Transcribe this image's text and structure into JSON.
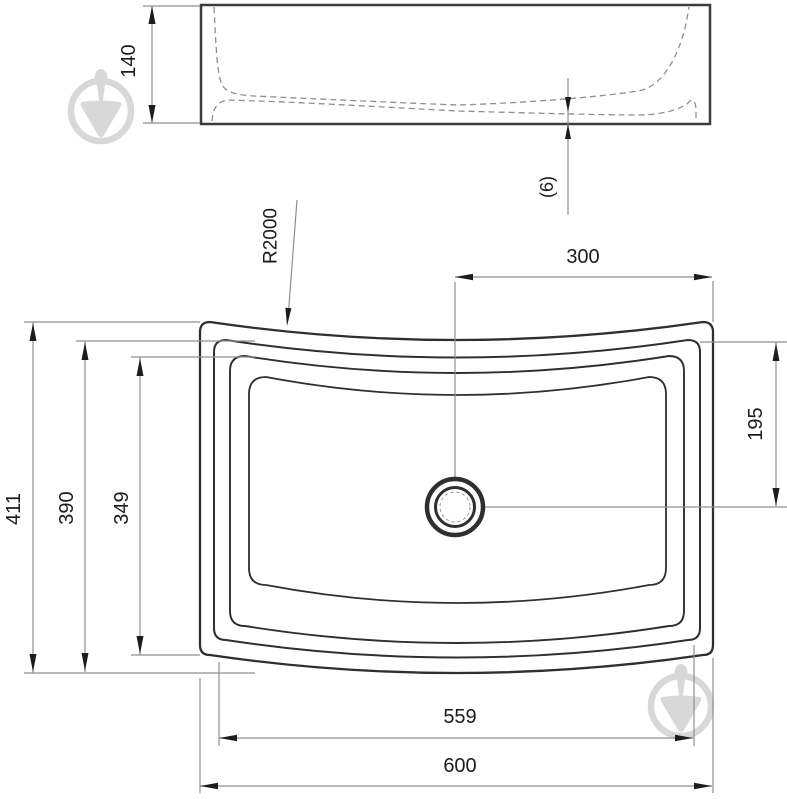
{
  "diagram": {
    "title": "Washbasin technical drawing (two orthographic views)",
    "views": {
      "side_view": "front elevation of basin with hidden interior profile (dashed)",
      "plan_view": "top view of basin with curved front/back edges and central drain"
    },
    "colors": {
      "background": "#ffffff",
      "contour": "#2f2f2f",
      "dimension_line": "#8f8f8f",
      "arrow_and_text": "#1c1c1c",
      "watermark": "#d8d8d8"
    },
    "watermark": {
      "name": "trowel-in-circle-logo",
      "positions": [
        "top-left",
        "bottom-right"
      ]
    }
  },
  "labels": {
    "side_height": "140",
    "bottom_thickness": "(6)",
    "edge_radius": "R2000",
    "drain_offset_x": "300",
    "drain_offset_y": "195",
    "overall_depth": "411",
    "basin_depth": "390",
    "inner_depth": "349",
    "inner_width": "559",
    "overall_width": "600"
  },
  "dimensions_mm": [
    {
      "value": "140",
      "meaning": "basin height, side view",
      "orientation": "vertical"
    },
    {
      "value": "(6)",
      "meaning": "bottom wall thickness reference",
      "orientation": "vertical"
    },
    {
      "value": "R2000",
      "meaning": "radius of curved front/back edge",
      "orientation": "leader"
    },
    {
      "value": "300",
      "meaning": "drain centre to right edge",
      "orientation": "horizontal"
    },
    {
      "value": "195",
      "meaning": "back edge to drain centre",
      "orientation": "vertical"
    },
    {
      "value": "411",
      "meaning": "overall depth",
      "orientation": "vertical"
    },
    {
      "value": "390",
      "meaning": "depth at centre line",
      "orientation": "vertical"
    },
    {
      "value": "349",
      "meaning": "inner bowl depth",
      "orientation": "vertical"
    },
    {
      "value": "559",
      "meaning": "inner bowl width",
      "orientation": "horizontal"
    },
    {
      "value": "600",
      "meaning": "overall width",
      "orientation": "horizontal"
    }
  ]
}
